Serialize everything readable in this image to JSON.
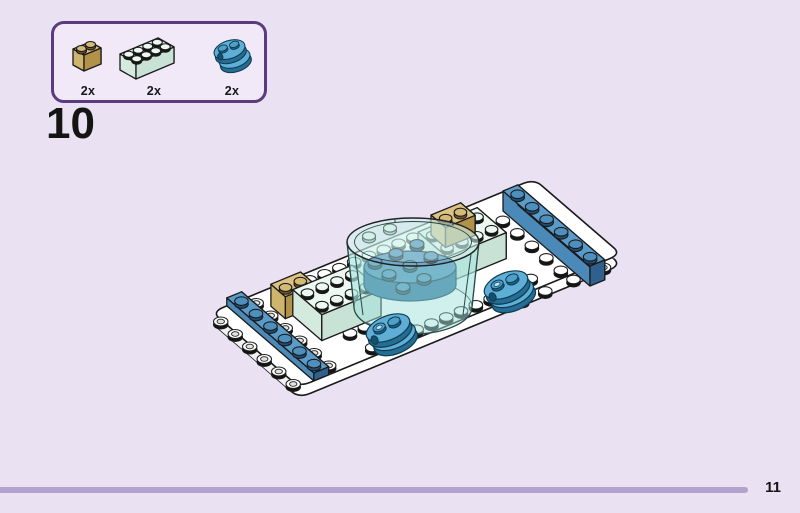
{
  "step": {
    "number": "10"
  },
  "parts_callout": {
    "items": [
      {
        "id": "tan-log-brick-1x2",
        "label": "2x"
      },
      {
        "id": "mint-brick-2x4",
        "label": "2x"
      },
      {
        "id": "azure-round-plate-1x2-stack",
        "label": "2x"
      }
    ]
  },
  "footer": {
    "page_number": "11"
  },
  "illustration": {
    "alt": "Isometric LEGO assembly: a long white plate with rounded ends; a blue 1x6 plate across the left end and a blue 1x6 brick across the right end between rows of hollow studs; two tan 1x2 log bricks; two mint 2x4 bricks; a transparent round tub in the centre holding blue round plates; two stacks of azure rounded 1x2 plates.",
    "colors": {
      "background": "#EAE1F2",
      "callout_border": "#5A3B7E",
      "callout_fill": "#F1E9F8",
      "divider": "#B2A2CE",
      "white_piece": "#FFFFFF",
      "mint": "#ECF8F1",
      "tan": "#DCC383",
      "blue": "#5B9BC9",
      "azure": "#5FAED6",
      "glass": "#BCEAE3"
    }
  }
}
